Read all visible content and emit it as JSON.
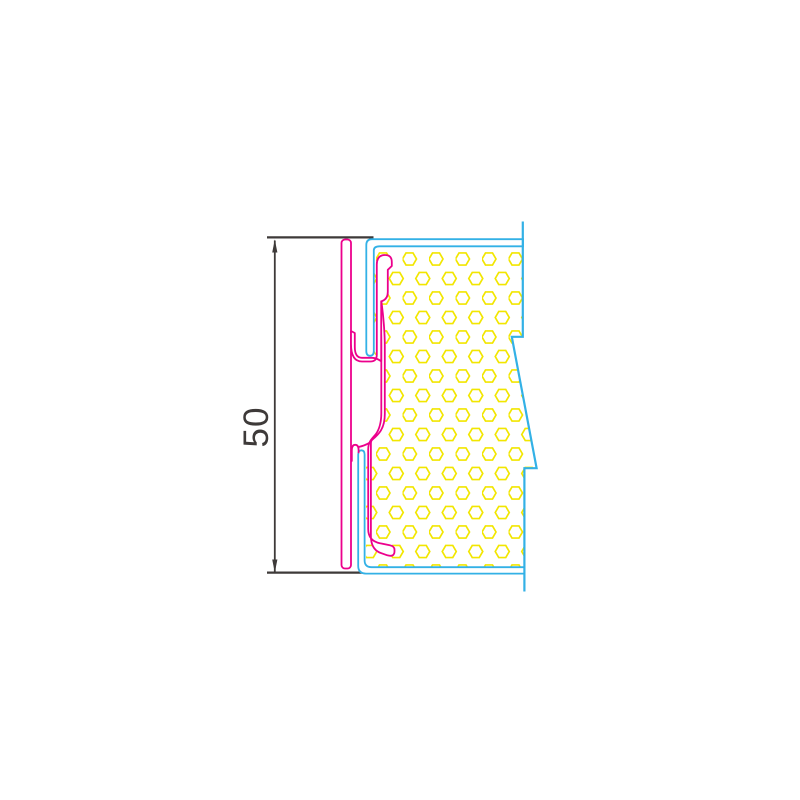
{
  "drawing": {
    "type": "technical-cross-section",
    "description": "Sandwich panel concealed joint cross-section with clip profile",
    "dimension": {
      "label": "50"
    },
    "colors": {
      "magenta": "#ec008c",
      "cyan": "#33b1e6",
      "yellow": "#f2e600",
      "dim": "#3e3a39",
      "background": "#ffffff"
    },
    "hatch": {
      "pattern": "hexagon-honeycomb",
      "hex_width": 14,
      "column_pitch": 26.5,
      "row_pitch": 19.5
    }
  }
}
